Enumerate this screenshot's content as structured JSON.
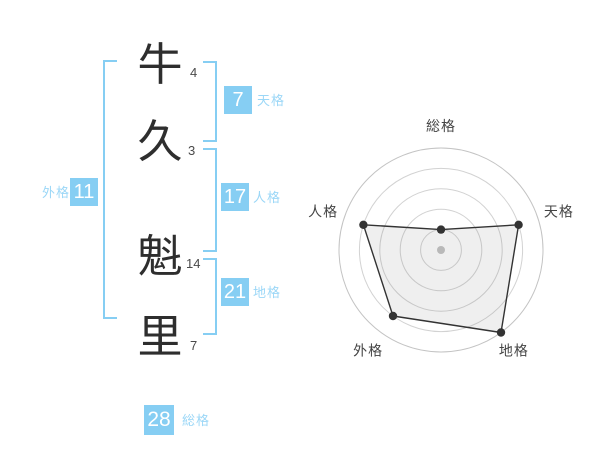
{
  "name": {
    "characters": [
      {
        "char": "牛",
        "strokes": "4"
      },
      {
        "char": "久",
        "strokes": "3"
      },
      {
        "char": "魁",
        "strokes": "14"
      },
      {
        "char": "里",
        "strokes": "7"
      }
    ]
  },
  "categories": {
    "tenkaku": {
      "label": "天格",
      "value": "7"
    },
    "jinkaku": {
      "label": "人格",
      "value": "17"
    },
    "chikaku": {
      "label": "地格",
      "value": "21"
    },
    "gaikaku": {
      "label": "外格",
      "value": "11"
    },
    "soukaku": {
      "label": "総格",
      "value": "28"
    }
  },
  "colors": {
    "accent_blue": "#86cef3",
    "label_blue": "#9bd7f7",
    "ink": "#2e2e2e",
    "grid_gray": "#d2d2d2",
    "polygon_stroke": "#333333",
    "center_dot": "#b9b9b9",
    "axis_label": "#444444"
  },
  "chart_data": {
    "type": "radar",
    "axes": [
      "総格",
      "天格",
      "地格",
      "外格",
      "人格"
    ],
    "values": [
      1,
      4,
      5,
      4,
      4
    ],
    "max": 5,
    "rings": 5,
    "start_angle_deg": 0,
    "direction": "clockwise",
    "grid": "concentric-circles",
    "legend": "none",
    "center_marker": true,
    "title": ""
  }
}
